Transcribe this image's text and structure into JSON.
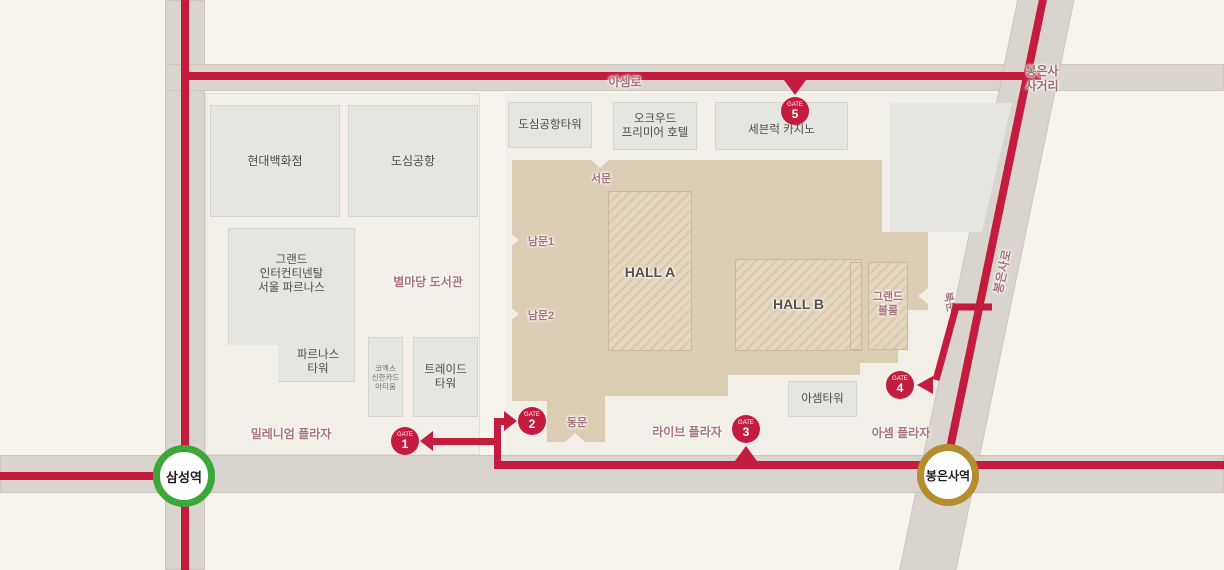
{
  "stations": {
    "samsung": {
      "name": "삼성역",
      "line_color": "#3ca83a"
    },
    "bongeunsa": {
      "name": "봉은사역",
      "line_color": "#b48d2e"
    }
  },
  "gates": {
    "gate1": {
      "word": "GATE",
      "num": "1"
    },
    "gate2": {
      "word": "GATE",
      "num": "2"
    },
    "gate3": {
      "word": "GATE",
      "num": "3"
    },
    "gate4": {
      "word": "GATE",
      "num": "4"
    },
    "gate5": {
      "word": "GATE",
      "num": "5"
    }
  },
  "roads": {
    "asemro": "아셈로",
    "bongeunsa_sageori": [
      "봉은사",
      "사거리"
    ],
    "bongeunsaro": "봉은사로"
  },
  "doors": {
    "west": "서문",
    "south1": "남문1",
    "south2": "남문2",
    "east": "동문",
    "north": "북문"
  },
  "halls": {
    "a": "HALL A",
    "b": "HALL B",
    "grand_ballroom": [
      "그랜드",
      "볼룸"
    ]
  },
  "buildings": {
    "hyundai": "현대백화점",
    "city_airport": "도심공항",
    "grand_intercontinental": [
      "그랜드",
      "인터컨티넨탈",
      "서울 파르나스"
    ],
    "parnas_tower": [
      "파르나스",
      "타워"
    ],
    "coex_artium": [
      "코엑스",
      "신한카드",
      "아티움"
    ],
    "trade_tower": [
      "트레이드",
      "타워"
    ],
    "city_airport_tower": "도심공항타워",
    "oakwood": [
      "오크우드",
      "프리미어 호텔"
    ],
    "seven_luck": "세븐럭 카지노",
    "asem_tower": "아셈타워"
  },
  "areas": {
    "byeolmadang": "별마당 도서관",
    "millennium": "밀레니엄 플라자",
    "live_plaza": "라이브 플라자",
    "asem_plaza": "아셈 플라자"
  },
  "colors": {
    "route_red": "#c31c3f",
    "samsung_line_green": "#3ca83a",
    "bongeunsa_line_gold": "#b48d2e",
    "coex_building_tan": "#dbccb4",
    "area_label_mauve": "#a8747c"
  }
}
